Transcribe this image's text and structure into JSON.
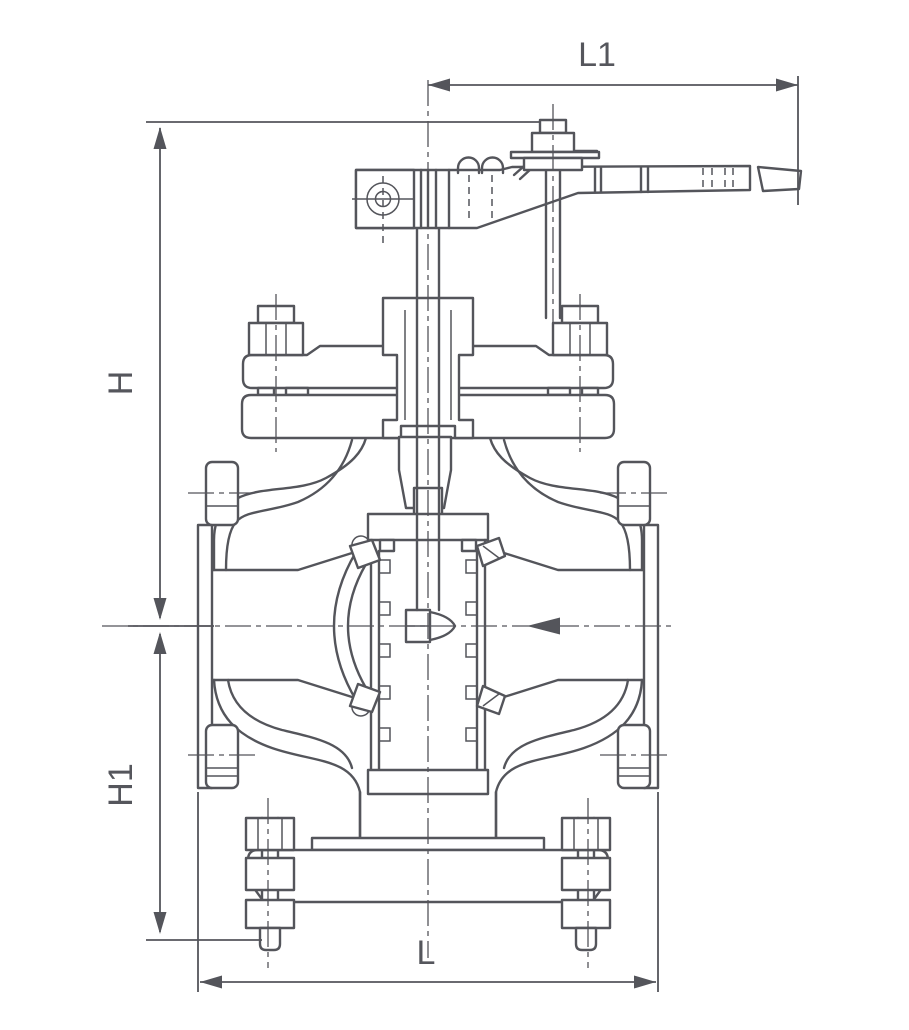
{
  "drawing": {
    "kind": "valve-cross-section-elevation",
    "background_color": "#ffffff",
    "line_color": "#54555b",
    "dimensions": {
      "top_length": {
        "label": "L1"
      },
      "upper_height": {
        "label": "H"
      },
      "lower_height": {
        "label": "H1"
      },
      "face_to_face": {
        "label": "L"
      }
    },
    "icons": {
      "flow_arrow": "flow-direction-left-arrow",
      "dimension_arrowheads": "dimension-arrowhead",
      "lever_pivot": "pivot-target-circle"
    }
  }
}
